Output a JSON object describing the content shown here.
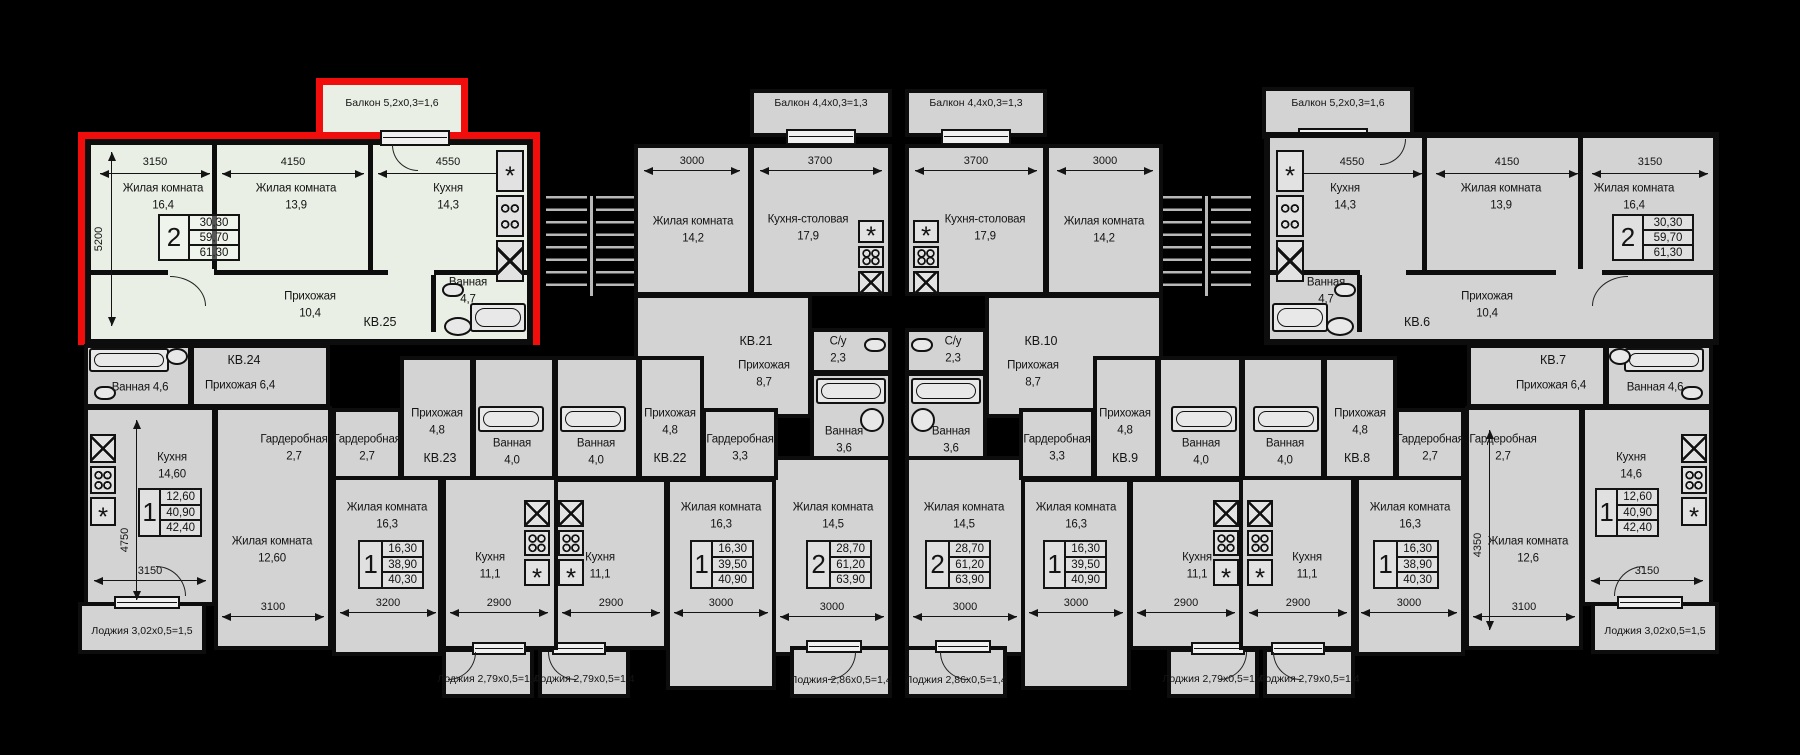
{
  "colors": {
    "background": "#000000",
    "room_fill": "#d3d3d3",
    "highlight_fill": "#e9efe4",
    "highlight_outline": "#f20d0d",
    "wall": "#0d0d0d"
  },
  "apartments": {
    "kv25": {
      "label": "КВ.25",
      "highlighted": true,
      "balcony": "Балкон 5,2х0,3=1,6",
      "stats": {
        "rooms": "2",
        "living": "30,30",
        "usable": "59,70",
        "total": "61,30"
      },
      "rooms": {
        "living1": {
          "name": "Жилая комната",
          "area": "16,4"
        },
        "living2": {
          "name": "Жилая комната",
          "area": "13,9"
        },
        "kitchen": {
          "name": "Кухня",
          "area": "14,3"
        },
        "hall": {
          "name": "Прихожая",
          "area": "10,4"
        },
        "bath": {
          "name": "Ванная",
          "area": "4,7"
        }
      },
      "dims": {
        "living1": "3150",
        "living2": "4150",
        "kitchen": "4550",
        "depth": "5200"
      }
    },
    "kv24": {
      "label": "КВ.24",
      "loggia": "Лоджия 3,02х0,5=1,5",
      "stats": {
        "rooms": "1",
        "living": "12,60",
        "usable": "40,90",
        "total": "42,40"
      },
      "rooms": {
        "bath": {
          "name": "Ванная",
          "area": "4,6"
        },
        "hall": {
          "name": "Прихожая",
          "area": "6,4"
        },
        "ward": {
          "name": "Гардеробная",
          "area": "2,7"
        },
        "kitchen": {
          "name": "Кухня",
          "area": "14,60"
        },
        "living": {
          "name": "Жилая комната",
          "area": "12,60"
        }
      },
      "dims": {
        "depth": "4750",
        "kitchen": "3150",
        "living": "3100"
      }
    },
    "kv23": {
      "label": "КВ.23",
      "loggia": "Лоджия 2,79х0,5=1,4",
      "stats": {
        "rooms": "1",
        "living": "16,30",
        "usable": "38,90",
        "total": "40,30"
      },
      "rooms": {
        "ward": {
          "name": "Гардеробная",
          "area": "2,7"
        },
        "hall": {
          "name": "Прихожая",
          "area": "4,8"
        },
        "bath": {
          "name": "Ванная",
          "area": "4,0"
        },
        "living": {
          "name": "Жилая комната",
          "area": "16,3"
        },
        "kitchen": {
          "name": "Кухня",
          "area": "11,1"
        }
      },
      "dims": {
        "living": "3200",
        "kitchen": "2900"
      }
    },
    "kv22": {
      "label": "КВ.22",
      "loggia": "Лоджия 2,79х0,5=1,4",
      "stats": {
        "rooms": "1",
        "living": "16,30",
        "usable": "39,50",
        "total": "40,90"
      },
      "rooms": {
        "bath": {
          "name": "Ванная",
          "area": "4,0"
        },
        "hall": {
          "name": "Прихожая",
          "area": "4,8"
        },
        "ward": {
          "name": "Гардеробная",
          "area": "3,3"
        },
        "kitchen": {
          "name": "Кухня",
          "area": "11,1"
        },
        "living": {
          "name": "Жилая комната",
          "area": "16,3"
        }
      },
      "dims": {
        "kitchen": "2900",
        "living": "3000"
      }
    },
    "kv21": {
      "label": "КВ.21",
      "balcony": "Балкон 4,4х0,3=1,3",
      "loggia": "Лоджия 2,86х0,5=1,4",
      "stats": {
        "rooms": "2",
        "living": "28,70",
        "usable": "61,20",
        "total": "63,90"
      },
      "rooms": {
        "living1": {
          "name": "Жилая комната",
          "area": "14,2"
        },
        "kitchen": {
          "name": "Кухня-столовая",
          "area": "17,9"
        },
        "hall": {
          "name": "Прихожая",
          "area": "8,7"
        },
        "su": {
          "name": "С/у",
          "area": "2,3"
        },
        "bath": {
          "name": "Ванная",
          "area": "3,6"
        },
        "living2": {
          "name": "Жилая комната",
          "area": "14,5"
        }
      },
      "dims": {
        "living1": "3000",
        "kitchen": "3700",
        "living2": "3000"
      }
    },
    "kv10": {
      "label": "КВ.10",
      "balcony": "Балкон 4,4х0,3=1,3",
      "loggia": "Лоджия 2,86х0,5=1,4",
      "stats": {
        "rooms": "2",
        "living": "28,70",
        "usable": "61,20",
        "total": "63,90"
      },
      "rooms": {
        "living1": {
          "name": "Жилая комната",
          "area": "14,2"
        },
        "kitchen": {
          "name": "Кухня-столовая",
          "area": "17,9"
        },
        "hall": {
          "name": "Прихожая",
          "area": "8,7"
        },
        "su": {
          "name": "С/у",
          "area": "2,3"
        },
        "bath": {
          "name": "Ванная",
          "area": "3,6"
        },
        "living2": {
          "name": "Жилая комната",
          "area": "14,5"
        }
      },
      "dims": {
        "living1": "3000",
        "kitchen": "3700",
        "living2": "3000"
      }
    },
    "kv9": {
      "label": "КВ.9",
      "loggia": "Лоджия 2,79х0,5=1,4",
      "stats": {
        "rooms": "1",
        "living": "16,30",
        "usable": "39,50",
        "total": "40,90"
      },
      "rooms": {
        "bath": {
          "name": "Ванная",
          "area": "4,0"
        },
        "hall": {
          "name": "Прихожая",
          "area": "4,8"
        },
        "ward": {
          "name": "Гардеробная",
          "area": "3,3"
        },
        "kitchen": {
          "name": "Кухня",
          "area": "11,1"
        },
        "living": {
          "name": "Жилая комната",
          "area": "16,3"
        }
      },
      "dims": {
        "kitchen": "2900",
        "living": "3000"
      }
    },
    "kv8": {
      "label": "КВ.8",
      "loggia": "Лоджия 2,79х0,5=1,4",
      "stats": {
        "rooms": "1",
        "living": "16,30",
        "usable": "38,90",
        "total": "40,30"
      },
      "rooms": {
        "bath": {
          "name": "Ванная",
          "area": "4,0"
        },
        "hall": {
          "name": "Прихожая",
          "area": "4,8"
        },
        "ward": {
          "name": "Гардеробная",
          "area": "2,7"
        },
        "kitchen": {
          "name": "Кухня",
          "area": "11,1"
        },
        "living": {
          "name": "Жилая комната",
          "area": "16,3"
        }
      },
      "dims": {
        "kitchen": "2900",
        "living": "3000"
      }
    },
    "kv7": {
      "label": "КВ.7",
      "loggia": "Лоджия 3,02х0,5=1,5",
      "stats": {
        "rooms": "1",
        "living": "12,60",
        "usable": "40,90",
        "total": "42,40"
      },
      "rooms": {
        "bath": {
          "name": "Ванная",
          "area": "4,6"
        },
        "hall": {
          "name": "Прихожая",
          "area": "6,4"
        },
        "ward": {
          "name": "Гардеробная",
          "area": "2,7"
        },
        "kitchen": {
          "name": "Кухня",
          "area": "14,6"
        },
        "living": {
          "name": "Жилая комната",
          "area": "12,6"
        }
      },
      "dims": {
        "depth": "4350",
        "kitchen": "3150",
        "living": "3100"
      }
    },
    "kv6": {
      "label": "КВ.6",
      "balcony": "Балкон 5,2х0,3=1,6",
      "stats": {
        "rooms": "2",
        "living": "30,30",
        "usable": "59,70",
        "total": "61,30"
      },
      "rooms": {
        "kitchen": {
          "name": "Кухня",
          "area": "14,3"
        },
        "living2": {
          "name": "Жилая комната",
          "area": "13,9"
        },
        "living1": {
          "name": "Жилая комната",
          "area": "16,4"
        },
        "hall": {
          "name": "Прихожая",
          "area": "10,4"
        },
        "bath": {
          "name": "Ванная",
          "area": "4,7"
        }
      },
      "dims": {
        "kitchen": "4550",
        "living2": "4150",
        "living1": "3150"
      }
    }
  }
}
